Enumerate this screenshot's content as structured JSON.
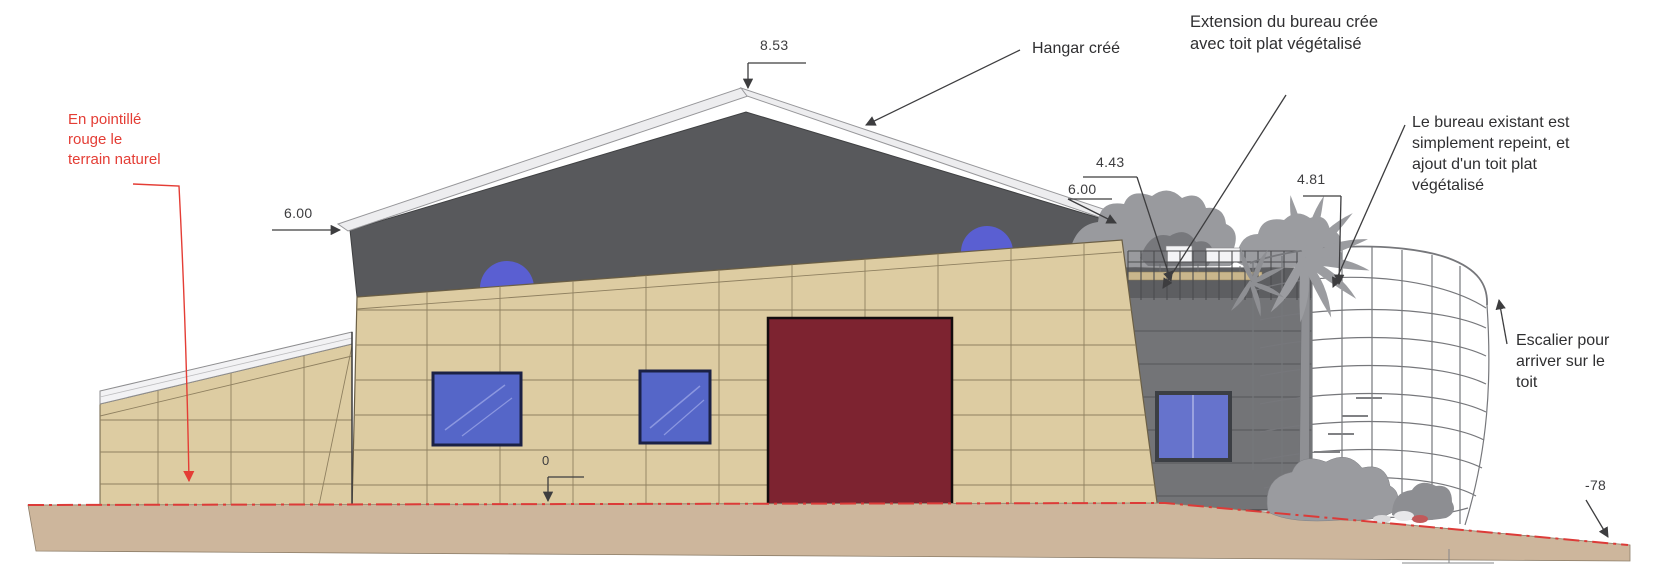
{
  "drawing": {
    "kind": "facade-elevation",
    "labels": {
      "terrain_note": "En pointillé rouge le terrain naturel",
      "hangar": "Hangar créé",
      "extension": "Extension du bureau crée avec toit plat végétalisé",
      "bureau": "Le bureau existant est simplement repeint, et ajout d'un toit plat végétalisé",
      "escalier": "Escalier pour arriver sur le toit"
    },
    "dimensions": {
      "ridge": "8.53",
      "eave_left": "6.00",
      "eave_right": "6.00",
      "extension_height": "4.43",
      "office_height": "4.81",
      "ground_level": "0",
      "terrain_low": "-78"
    },
    "colors": {
      "roof": "#58595c",
      "roof_trim": "#ededef",
      "wall": "#ddcca2",
      "wall_grid": "#8f8060",
      "door": "#7d2330",
      "window": "#5566c8",
      "dome": "#5a5fd2",
      "extension_wall": "#737477",
      "vegetation": "#9a9b9f",
      "terrain": "#cdb69c",
      "terrain_line": "#dc3b38",
      "ink": "#3d3d3f",
      "annotation_red": "#e43d35"
    }
  }
}
